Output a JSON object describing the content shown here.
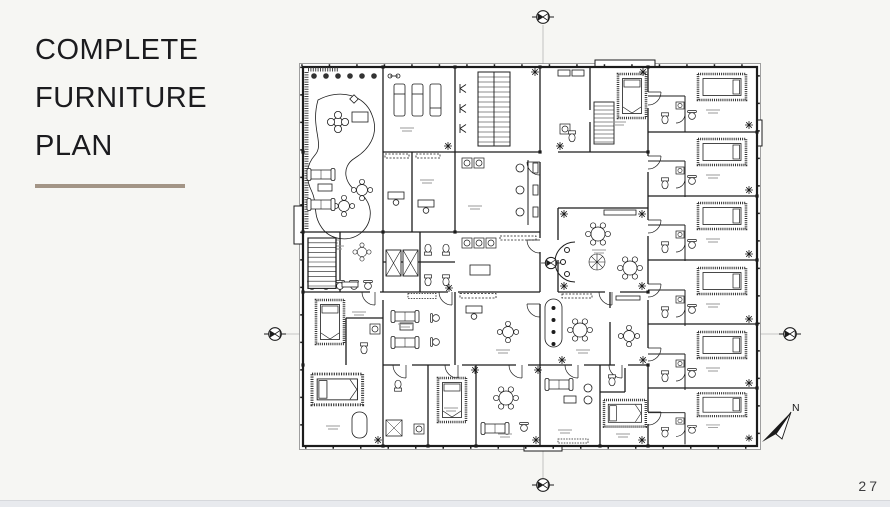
{
  "slide": {
    "title_lines": [
      "COMPLETE",
      "FURNITURE",
      "PLAN"
    ],
    "page_number": "27"
  },
  "plan": {
    "description_icon_names": [
      "section-marker-icon",
      "north-arrow-icon"
    ],
    "north_label": "N"
  },
  "theme": {
    "background": "#f6f6f3",
    "title_color": "#1b1b1e",
    "divider_color": "#a39586",
    "plan_ink": "#1c1c1c",
    "centerline_color": "#b7b7b5",
    "footer_bar_color": "#e8eaee",
    "page_number_color": "#3e3e40"
  }
}
